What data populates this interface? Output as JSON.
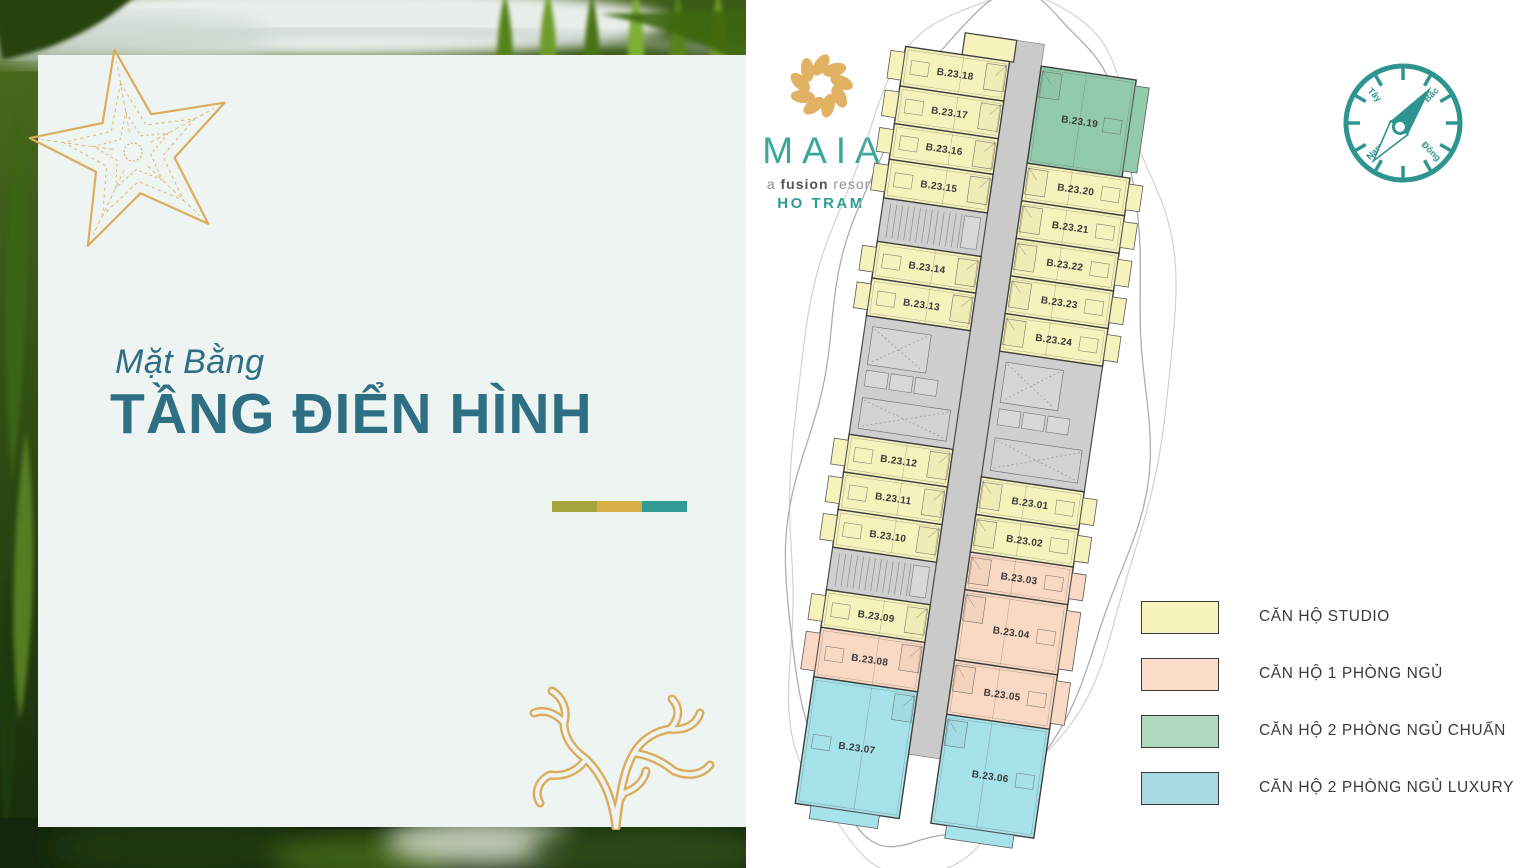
{
  "left_panel": {
    "background_color": "#EDF4F1",
    "subtitle": "Mặt Bằng",
    "title": "TẦNG ĐIỂN HÌNH",
    "title_color": "#2E6F83",
    "accent_bars": [
      "#A3A73B",
      "#D8AE49",
      "#339B96"
    ],
    "decor_icons": [
      "starfish",
      "coral"
    ],
    "decor_color": "#DCAC5C"
  },
  "logo": {
    "name": "MAIA",
    "tagline_prefix": "a ",
    "tagline_bold": "fusion",
    "tagline_suffix": " resort",
    "location": "HO TRAM",
    "flower_color": "#E2B264",
    "name_color": "#3AA79D",
    "location_color": "#2E9C96"
  },
  "compass": {
    "color": "#2E9490",
    "needle_bearing_deg": 38,
    "labels": {
      "north": "Bắc",
      "west": "Tây",
      "south": "Nam",
      "east": "Đông"
    }
  },
  "floor_plan": {
    "colors": {
      "studio": "#F6F2BB",
      "one_bedroom": "#F9D9C3",
      "two_bedroom_standard": "#92CBAC",
      "two_bedroom_luxury": "#A5E2EA",
      "corridor": "#CACACA",
      "core": "#CFCFCF",
      "wall": "#3F3F3F",
      "detail": "#6E6E6E",
      "outline": "#ACAEAE",
      "label": "#3A3A3A"
    },
    "units": [
      {
        "label": "B.23.18",
        "type": "studio",
        "side": "L",
        "y0": -370,
        "y1": -330
      },
      {
        "label": "B.23.17",
        "type": "studio",
        "side": "L",
        "y0": -330,
        "y1": -292
      },
      {
        "label": "B.23.16",
        "type": "studio",
        "side": "L",
        "y0": -292,
        "y1": -256
      },
      {
        "label": "B.23.15",
        "type": "studio",
        "side": "L",
        "y0": -256,
        "y1": -217
      },
      {
        "label": "B.23.14",
        "type": "studio",
        "side": "L",
        "y0": -173,
        "y1": -136
      },
      {
        "label": "B.23.13",
        "type": "studio",
        "side": "L",
        "y0": -136,
        "y1": -98
      },
      {
        "label": "B.23.12",
        "type": "studio",
        "side": "L",
        "y0": 22,
        "y1": 60
      },
      {
        "label": "B.23.11",
        "type": "studio",
        "side": "L",
        "y0": 60,
        "y1": 98
      },
      {
        "label": "B.23.10",
        "type": "studio",
        "side": "L",
        "y0": 98,
        "y1": 136
      },
      {
        "label": "B.23.09",
        "type": "studio",
        "side": "L",
        "y0": 179,
        "y1": 217
      },
      {
        "label": "B.23.08",
        "type": "one_bedroom",
        "side": "L",
        "y0": 217,
        "y1": 267
      },
      {
        "label": "B.23.07",
        "type": "two_bedroom_luxury",
        "side": "L",
        "y0": 267,
        "y1": 395
      },
      {
        "label": "B.23.19",
        "type": "two_bedroom_standard",
        "side": "R",
        "y0": -370,
        "y1": -272
      },
      {
        "label": "B.23.20",
        "type": "studio",
        "side": "R",
        "y0": -272,
        "y1": -234
      },
      {
        "label": "B.23.21",
        "type": "studio",
        "side": "R",
        "y0": -234,
        "y1": -196
      },
      {
        "label": "B.23.22",
        "type": "studio",
        "side": "R",
        "y0": -196,
        "y1": -158
      },
      {
        "label": "B.23.23",
        "type": "studio",
        "side": "R",
        "y0": -158,
        "y1": -120
      },
      {
        "label": "B.23.24",
        "type": "studio",
        "side": "R",
        "y0": -120,
        "y1": -82
      },
      {
        "label": "B.23.01",
        "type": "studio",
        "side": "R",
        "y0": 45,
        "y1": 83
      },
      {
        "label": "B.23.02",
        "type": "studio",
        "side": "R",
        "y0": 83,
        "y1": 121
      },
      {
        "label": "B.23.03",
        "type": "one_bedroom",
        "side": "R",
        "y0": 121,
        "y1": 159
      },
      {
        "label": "B.23.04",
        "type": "one_bedroom",
        "side": "R",
        "y0": 159,
        "y1": 230
      },
      {
        "label": "B.23.05",
        "type": "one_bedroom",
        "side": "R",
        "y0": 230,
        "y1": 285
      },
      {
        "label": "B.23.06",
        "type": "two_bedroom_luxury",
        "side": "R",
        "y0": 285,
        "y1": 395
      }
    ],
    "cores": [
      {
        "kind": "stairs",
        "side": "L",
        "y0": -217,
        "y1": -173
      },
      {
        "kind": "lobby",
        "side": "L",
        "y0": -98,
        "y1": 22
      },
      {
        "kind": "stairs",
        "side": "L",
        "y0": 136,
        "y1": 179
      },
      {
        "kind": "lobby",
        "side": "R",
        "y0": -82,
        "y1": 45
      }
    ]
  },
  "legend": {
    "items": [
      {
        "label": "CĂN HỘ STUDIO",
        "color": "#F6F3BD"
      },
      {
        "label": "CĂN HỘ 1 PHÒNG NGỦ",
        "color": "#FBDCC8"
      },
      {
        "label": "CĂN HỘ 2 PHÒNG NGỦ CHUẨN",
        "color": "#B0D9BF"
      },
      {
        "label": "CĂN HỘ 2 PHÒNG NGỦ LUXURY",
        "color": "#A9DAE4"
      }
    ]
  }
}
